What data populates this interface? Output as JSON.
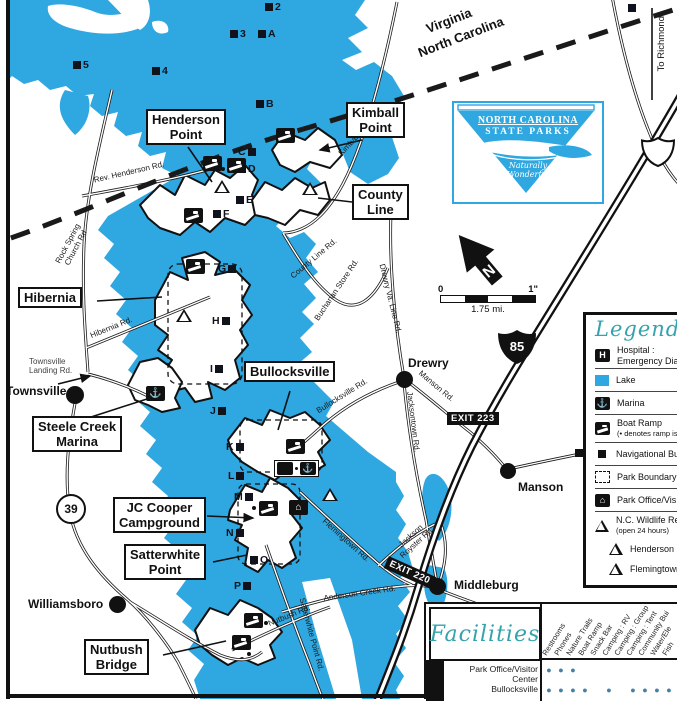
{
  "colors": {
    "lake": "#2FA7E0",
    "teal": "#35A3AB",
    "facility_dot": "#447FA6"
  },
  "map": {
    "state_line": {
      "va": "Virginia",
      "nc": "North Carolina"
    },
    "to_richmond": "To Richmond",
    "place_boxes": {
      "henderson": {
        "l1": "Henderson",
        "l2": "Point"
      },
      "kimball": {
        "l1": "Kimball",
        "l2": "Point"
      },
      "county_line": {
        "l1": "County",
        "l2": "Line"
      },
      "hibernia": {
        "l1": "Hibernia"
      },
      "steele_creek": {
        "l1": "Steele Creek",
        "l2": "Marina"
      },
      "bullocksville": {
        "l1": "Bullocksville"
      },
      "jc_cooper": {
        "l1": "JC Cooper",
        "l2": "Campground"
      },
      "satterwhite": {
        "l1": "Satterwhite",
        "l2": "Point"
      },
      "nutbush": {
        "l1": "Nutbush",
        "l2": "Bridge"
      }
    },
    "towns": {
      "townsville": "Townsville",
      "williamsboro": "Williamsboro",
      "drewry": "Drewry",
      "manson": "Manson",
      "middleburg": "Middleburg"
    },
    "roads": {
      "rev_henderson": "Rev. Henderson Rd.",
      "rock_spring_1": "Rock Spring",
      "rock_spring_2": "Church Rd",
      "hibernia": "Hibernia Rd.",
      "townsville_landing_1": "Townsville",
      "townsville_landing_2": "Landing Rd.",
      "kimball": "Kimball Rd.",
      "county_line": "County Line Rd.",
      "buchanan": "Buchanan Store Rd.",
      "drewry_va": "Drewry Va. Line Rd.",
      "bullocksville": "Bullocksville Rd.",
      "manson": "Manson Rd.",
      "jacksontown": "Jacksontown Rd.",
      "flemingtown": "Flemingtown Rd.",
      "jackson_royster_1": "Jackson",
      "jackson_royster_2": "Royster Rd.",
      "anderson_creek": "Anderson Creek Rd.",
      "nutbush": "Nutbush Rd.",
      "satterwhite": "Satterwhite Point Rd."
    },
    "highway": {
      "i85": "85",
      "exit223": "EXIT 223",
      "exit220": "EXIT 220",
      "route39": "39"
    },
    "compass_n": "N",
    "scale": {
      "left": "0",
      "right": "1\"",
      "caption": "1.75 mi."
    },
    "buoys": [
      "2",
      "3",
      "A",
      "4",
      "5",
      "B",
      "C",
      "D",
      "E",
      "F",
      "G",
      "H",
      "I",
      "J",
      "K",
      "L",
      "M",
      "N",
      "O",
      "P"
    ]
  },
  "logo": {
    "l1": "NORTH CAROLINA",
    "l2": "STATE PARKS",
    "t1": "Naturally",
    "t2": "Wonderful"
  },
  "icons": {
    "marina": "⚓",
    "office": "⌂",
    "hospital": "H"
  },
  "legend": {
    "title": "Legend",
    "items": [
      {
        "name": "hospital",
        "line1": "Hospital :",
        "line2": "Emergency Dia"
      },
      {
        "name": "lake",
        "line1": "Lake"
      },
      {
        "name": "marina",
        "line1": "Marina"
      },
      {
        "name": "boat-ramp",
        "line1": "Boat Ramp",
        "line2": "(• denotes ramp is"
      },
      {
        "name": "nav-buoy",
        "line1": "Navigational Bu"
      },
      {
        "name": "park-boundary",
        "line1": "Park Boundary"
      },
      {
        "name": "park-office",
        "line1": "Park Office/Vis"
      },
      {
        "name": "wildlife-ramp",
        "line1": "N.C. Wildlife Re",
        "line2": "(open 24 hours)"
      },
      {
        "name": "henderson-ramp",
        "line1": "Henderson Po"
      },
      {
        "name": "flemingtown-ramp",
        "line1": "Flemingtown"
      }
    ]
  },
  "facilities": {
    "title": "Facilities",
    "columns": [
      "Restrooms",
      "Phones",
      "Nature Trails",
      "Boat Ramp",
      "Snack Bar",
      "Camping : RV",
      "Camping : Group",
      "Camping : Tent",
      "Community Bui",
      "Water/Ele",
      "Fish"
    ],
    "rows": [
      {
        "label": "Park Office/Visitor Center",
        "dots": [
          "●",
          "●",
          "●",
          "",
          "",
          "",
          "",
          "",
          "",
          "",
          ""
        ]
      },
      {
        "label": "Bullocksville",
        "dots": [
          "●",
          "●",
          "●",
          "●",
          "",
          "●",
          "",
          "●",
          "●",
          "●",
          "●"
        ]
      }
    ]
  }
}
